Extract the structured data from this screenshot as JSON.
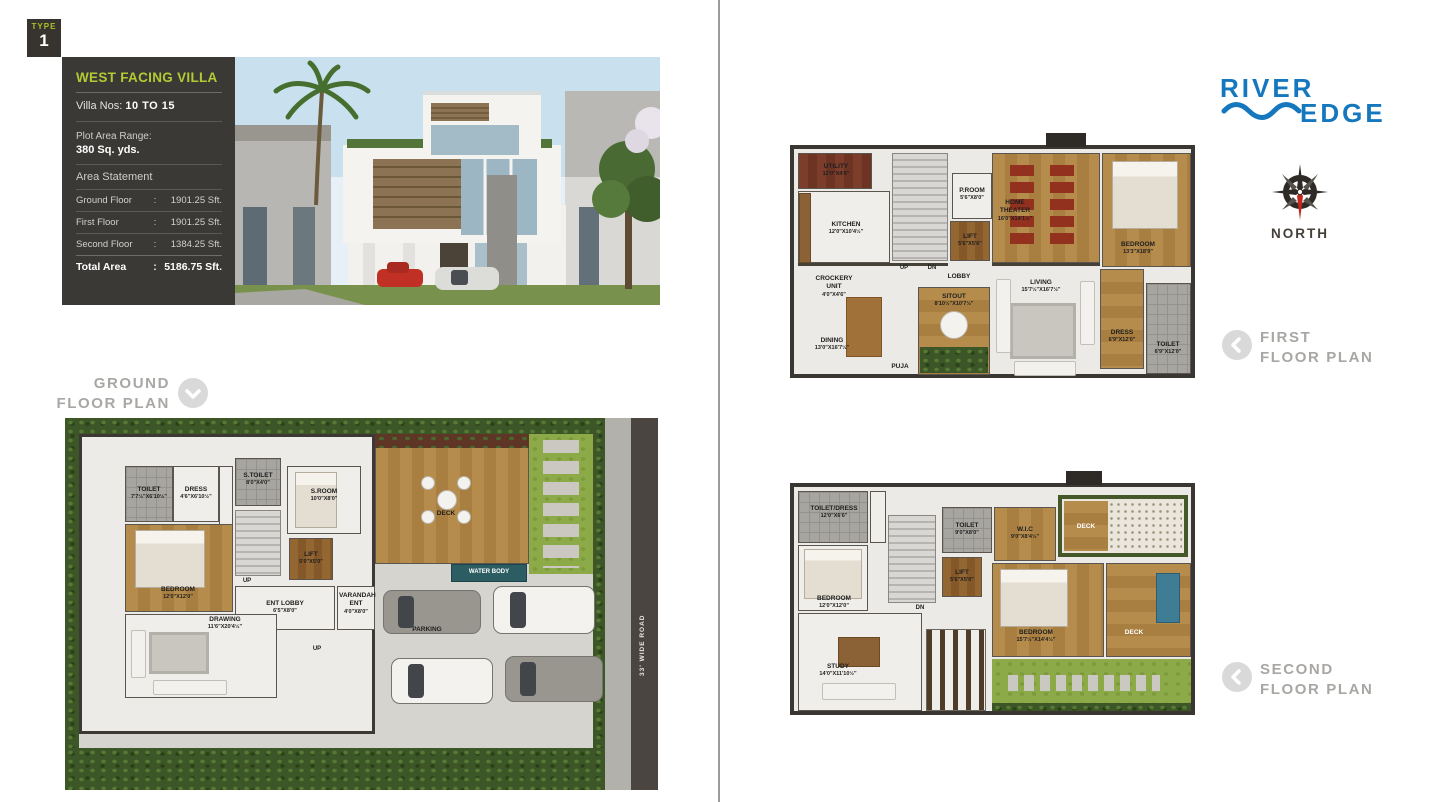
{
  "type_badge": {
    "label": "TYPE",
    "number": "1"
  },
  "info_panel": {
    "title": "WEST FACING VILLA",
    "villa_nos_label": "Villa Nos:",
    "villa_nos_value": "10 TO 15",
    "plot_area_label": "Plot Area Range:",
    "plot_area_value": "380 Sq. yds.",
    "area_statement": "Area Statement",
    "rows": [
      {
        "label": "Ground Floor",
        "colon": ":",
        "value": "1901.25 Sft."
      },
      {
        "label": "First Floor",
        "colon": ":",
        "value": "1901.25  Sft."
      },
      {
        "label": "Second Floor",
        "colon": ":",
        "value": "1384.25 Sft."
      }
    ],
    "total_label": "Total Area",
    "total_colon": ":",
    "total_value": "5186.75 Sft."
  },
  "brand": {
    "word1": "RIVER",
    "word2": "EDGE",
    "color": "#1577BD"
  },
  "compass": {
    "label": "NORTH"
  },
  "titles": {
    "ground1": "GROUND",
    "ground2": "FLOOR PLAN",
    "first1": "FIRST",
    "first2": "FLOOR PLAN",
    "second1": "SECOND",
    "second2": "FLOOR PLAN"
  },
  "ground": {
    "rooms": {
      "toilet": {
        "name": "TOILET",
        "dim": "7'7½\"X6'10½\""
      },
      "dress": {
        "name": "DRESS",
        "dim": "4'6\"X6'10½\""
      },
      "stoilet": {
        "name": "S.TOILET",
        "dim": "8'0\"X4'0\""
      },
      "sroom": {
        "name": "S.ROOM",
        "dim": "10'0\"X8'0\""
      },
      "lift": {
        "name": "LIFT",
        "dim": "5'0\"X5'0\""
      },
      "bedroom": {
        "name": "BEDROOM",
        "dim": "12'0\"X12'0\""
      },
      "entlobby": {
        "name": "ENT LOBBY",
        "dim": "6'5\"X8'0\""
      },
      "varandah": {
        "name": "VARANDAH ENT",
        "dim": "4'0\"X8'0\""
      },
      "drawing": {
        "name": "DRAWING",
        "dim": "11'6\"X20'4½\""
      },
      "deck": {
        "name": "DECK"
      },
      "water": {
        "name": "WATER BODY"
      },
      "parking": {
        "name": "PARKING"
      },
      "up1": "UP",
      "up2": "UP",
      "road": "33' WIDE ROAD"
    }
  },
  "first": {
    "rooms": {
      "utility": {
        "name": "UTILITY",
        "dim": "12'0\"X4'6\""
      },
      "kitchen": {
        "name": "KITCHEN",
        "dim": "12'0\"X10'4½\""
      },
      "proom": {
        "name": "P.ROOM",
        "dim": "5'6\"X8'0\""
      },
      "lift": {
        "name": "LIFT",
        "dim": "5'6\"X5'6\""
      },
      "theater": {
        "name": "HOME THEATER",
        "dim": "16'0\"X14'1½\""
      },
      "bedroom": {
        "name": "BEDROOM",
        "dim": "13'3\"X18'9\""
      },
      "crockery": {
        "name": "CROCKERY UNIT",
        "dim": "4'0\"X4'6\""
      },
      "dining": {
        "name": "DINING",
        "dim": "13'0\"X16'7½\""
      },
      "lobby": {
        "name": "LOBBY"
      },
      "sitout": {
        "name": "SITOUT",
        "dim": "8'10½\"X10'7½\""
      },
      "puja": {
        "name": "PUJA"
      },
      "living": {
        "name": "LIVING",
        "dim": "15'7½\"X16'7½\""
      },
      "dress": {
        "name": "DRESS",
        "dim": "6'9\"X12'0\""
      },
      "toilet": {
        "name": "TOILET",
        "dim": "6'9\"X12'0\""
      },
      "up": "UP",
      "dn": "DN"
    }
  },
  "second": {
    "rooms": {
      "toiletdress": {
        "name": "TOILET/DRESS",
        "dim": "12'0\"X6'6\""
      },
      "bedroom1": {
        "name": "BEDROOM",
        "dim": "12'0\"X12'0\""
      },
      "toilet": {
        "name": "TOILET",
        "dim": "9'0\"X8'0\""
      },
      "lift": {
        "name": "LIFT",
        "dim": "5'6\"X5'0\""
      },
      "wic": {
        "name": "W.I.C",
        "dim": "9'0\"X8'4½\""
      },
      "deck1": {
        "name": "DECK"
      },
      "bedroom2": {
        "name": "BEDROOM",
        "dim": "15'7½\"X14'4½\""
      },
      "deck2": {
        "name": "DECK"
      },
      "study": {
        "name": "STUDY",
        "dim": "14'0\"X11'10½\""
      },
      "dn": "DN"
    }
  }
}
